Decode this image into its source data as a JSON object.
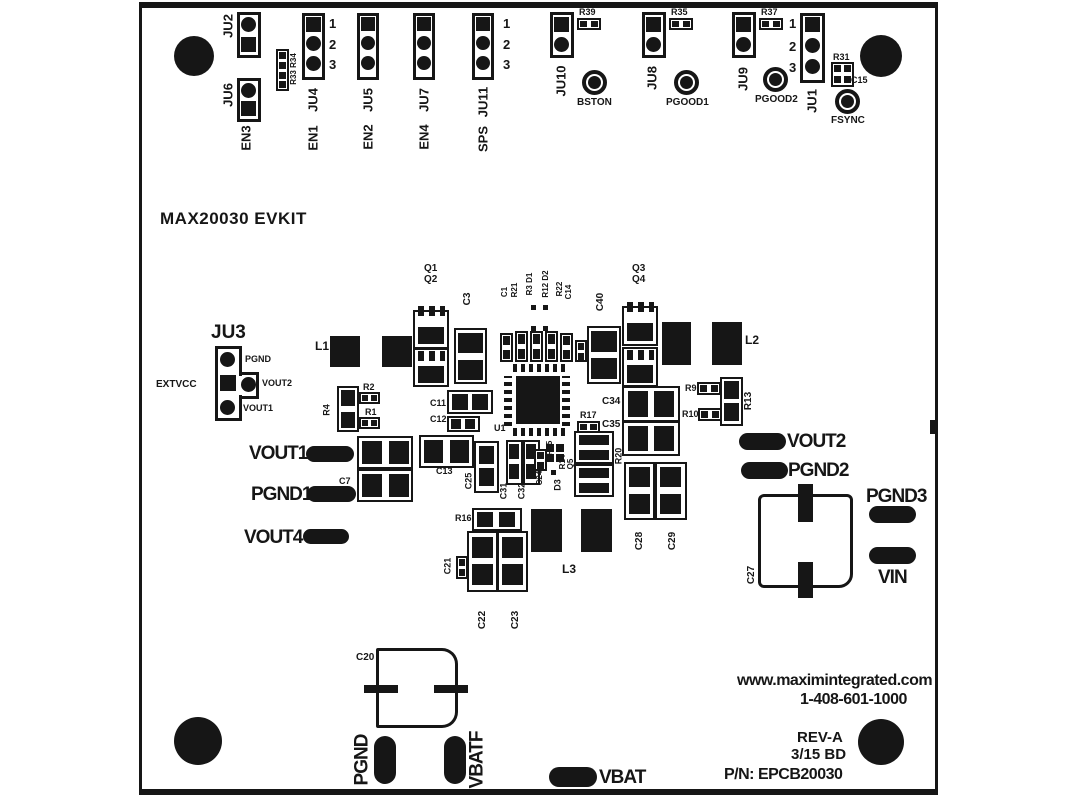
{
  "title": "MAX20030 EVKIT",
  "n": {
    "n1": "1",
    "n2": "2",
    "n3": "3"
  },
  "t": {
    "ju2": "JU2",
    "ju6": "JU6",
    "en3": "EN3",
    "r3334": "R33 R34",
    "ju4": "JU4",
    "en1": "EN1",
    "ju5": "JU5",
    "en2": "EN2",
    "ju7": "JU7",
    "en4": "EN4",
    "ju11": "JU11",
    "sps": "SPS",
    "ju10": "JU10",
    "r39": "R39",
    "bston": "BSTON",
    "ju8": "JU8",
    "r35": "R35",
    "pgood1": "PGOOD1",
    "ju9": "JU9",
    "r37": "R37",
    "pgood2": "PGOOD2",
    "ju1": "JU1",
    "r31": "R31",
    "c15": "C15",
    "fsync": "FSYNC"
  },
  "j3": {
    "name": "JU3",
    "extvcc": "EXTVCC",
    "pgnd": "PGND",
    "vout2": "VOUT2",
    "vout1": "VOUT1"
  },
  "c": {
    "l1": "L1",
    "q1": "Q1",
    "q2": "Q2",
    "c3": "C3",
    "c1": "C1",
    "r21": "R21",
    "r3d1": "R3 D1",
    "r12d2": "R12 D2",
    "r22": "R22",
    "c14": "C14",
    "c40": "C40",
    "q3": "Q3",
    "q4": "Q4",
    "l2": "L2",
    "u1": "U1",
    "r4": "R4",
    "r2": "R2",
    "r1": "R1",
    "c11": "C11",
    "c12": "C12",
    "c34": "C34",
    "c35": "C35",
    "r17": "R17",
    "r9": "R9",
    "r10": "R10",
    "r13": "R13",
    "c7": "C7",
    "c13": "C13",
    "c25": "C25",
    "c31": "C31",
    "c32": "C32",
    "c24": "C24",
    "r15": "R15",
    "r14": "R14",
    "q5": "Q5",
    "d3": "D3",
    "r20": "R20",
    "r16": "R16",
    "c21": "C21",
    "c22": "C22",
    "c23": "C23",
    "l3": "L3",
    "c28": "C28",
    "c29": "C29",
    "c27": "C27",
    "c20": "C20"
  },
  "p": {
    "vout1": "VOUT1",
    "pgnd1": "PGND1",
    "vout4": "VOUT4",
    "vout2": "VOUT2",
    "pgnd2": "PGND2",
    "pgnd3": "PGND3",
    "vin": "VIN",
    "pgnd": "PGND",
    "vbatf": "VBATF",
    "vbat": "VBAT"
  },
  "f": {
    "web": "www.maximintegrated.com",
    "phone": "1-408-601-1000",
    "rev": "REV-A",
    "date": "3/15 BD",
    "pn": "P/N: EPCB20030"
  }
}
